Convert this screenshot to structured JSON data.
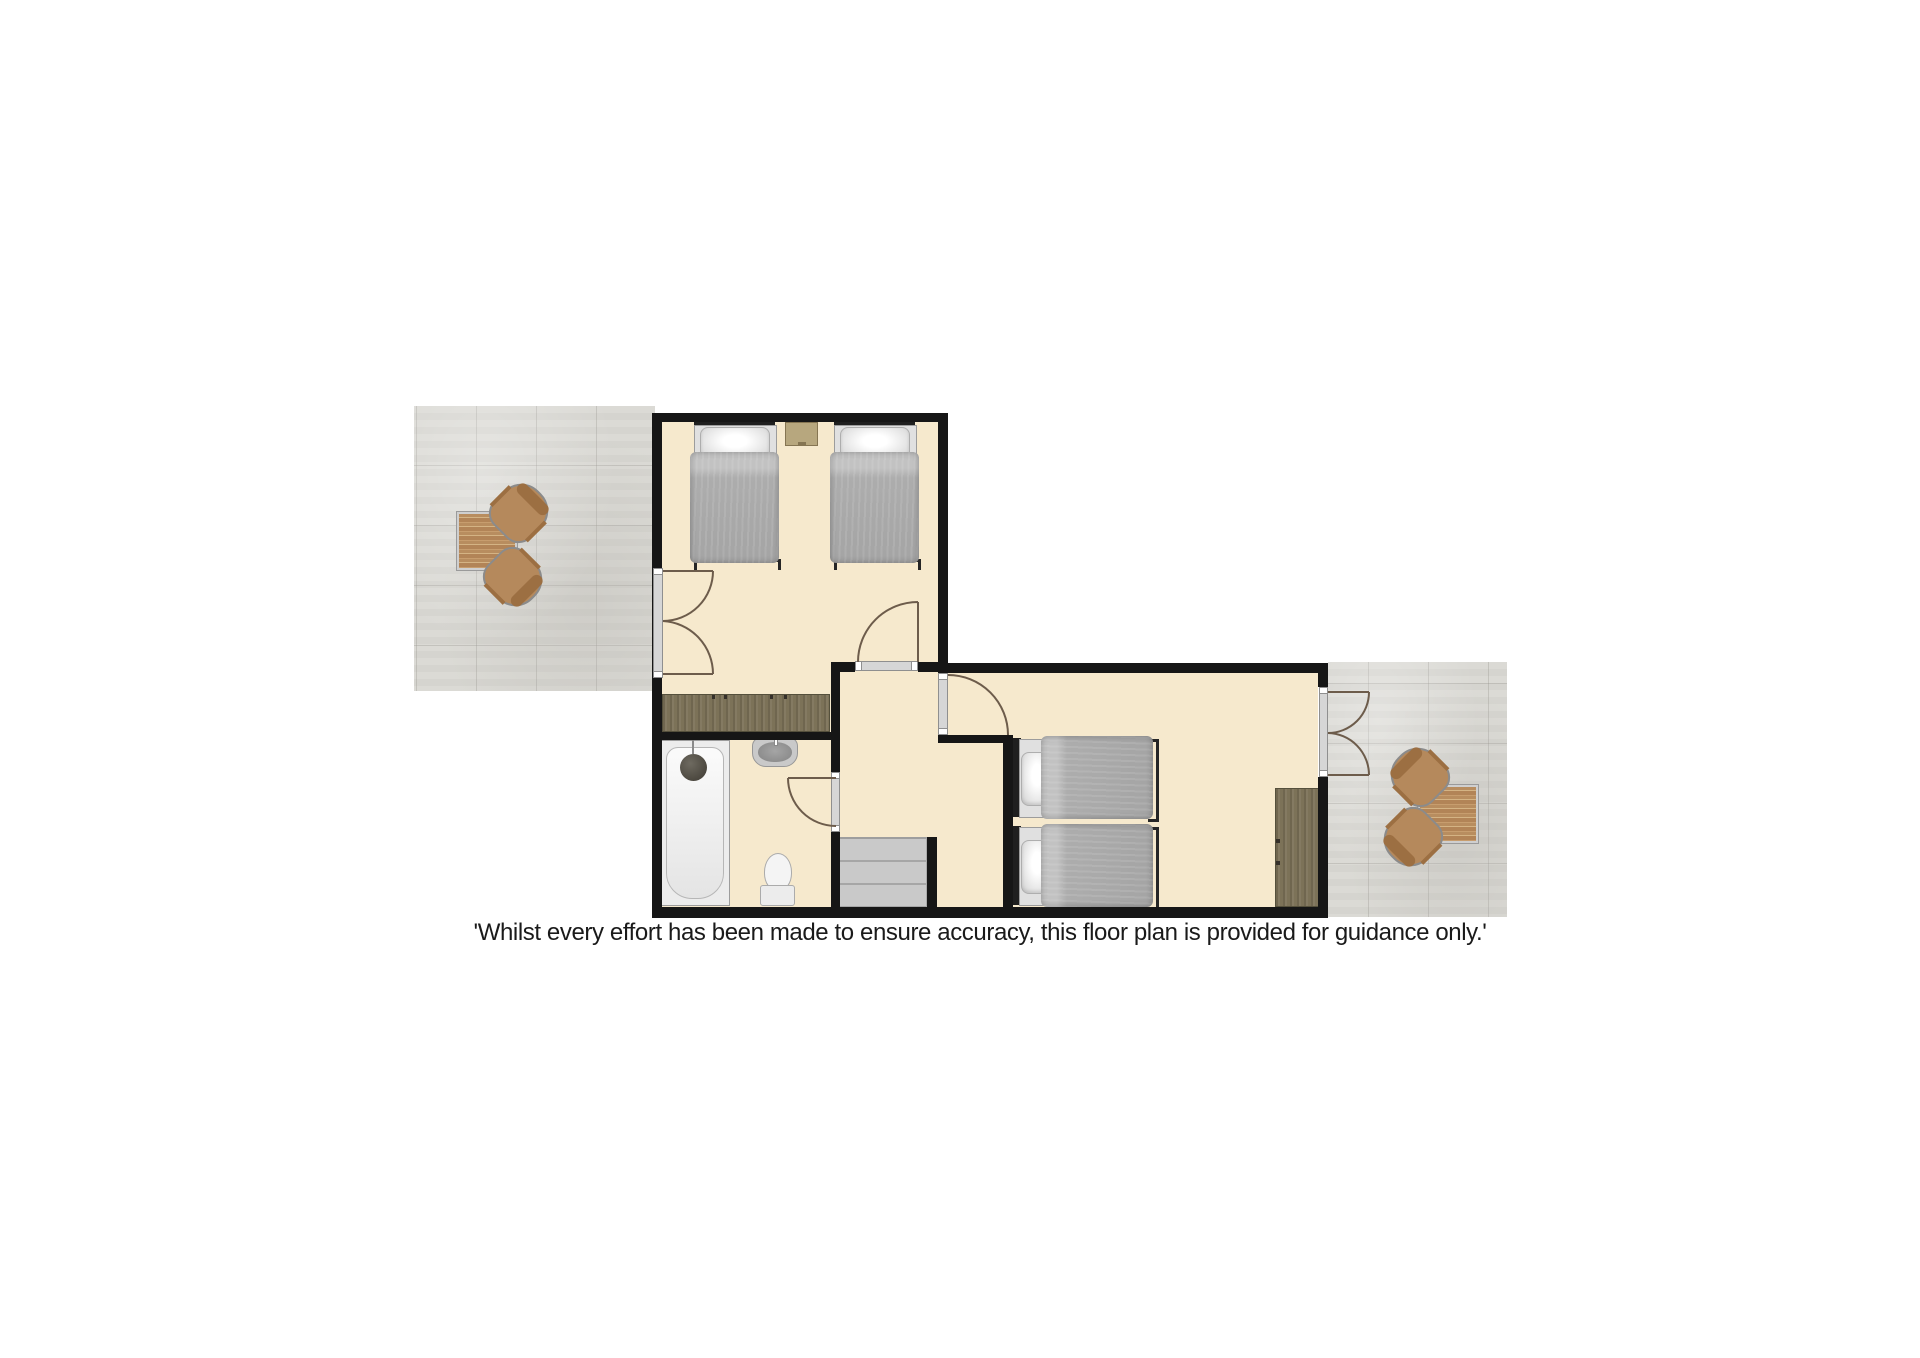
{
  "disclaimer": "'Whilst every effort has been made to ensure accuracy, this floor plan is provided for guidance only.'",
  "palette": {
    "wall": "#161616",
    "room_floor": "#f6e9cd",
    "patio_tile": "#d9d8d3",
    "dark_wood": "#7c7258",
    "garden_wood": "#b5895c",
    "bed_linen": "#a4a4a4",
    "stairs": "#c6c6c6",
    "door_swing": "#6d5c4b",
    "text": "#1a1a1a"
  },
  "floorplan": {
    "rooms": [
      {
        "name": "bedroom-top",
        "furniture": [
          "single-bed",
          "single-bed",
          "bedside-table",
          "wardrobe"
        ]
      },
      {
        "name": "bathroom",
        "furniture": [
          "bathtub",
          "basin",
          "toilet"
        ]
      },
      {
        "name": "landing",
        "furniture": [
          "staircase"
        ]
      },
      {
        "name": "bedroom-right",
        "furniture": [
          "single-bed",
          "single-bed",
          "wardrobe"
        ]
      },
      {
        "name": "patio-left",
        "furniture": [
          "garden-table",
          "garden-chair",
          "garden-chair"
        ]
      },
      {
        "name": "patio-right",
        "furniture": [
          "garden-table",
          "garden-chair",
          "garden-chair"
        ]
      }
    ]
  }
}
